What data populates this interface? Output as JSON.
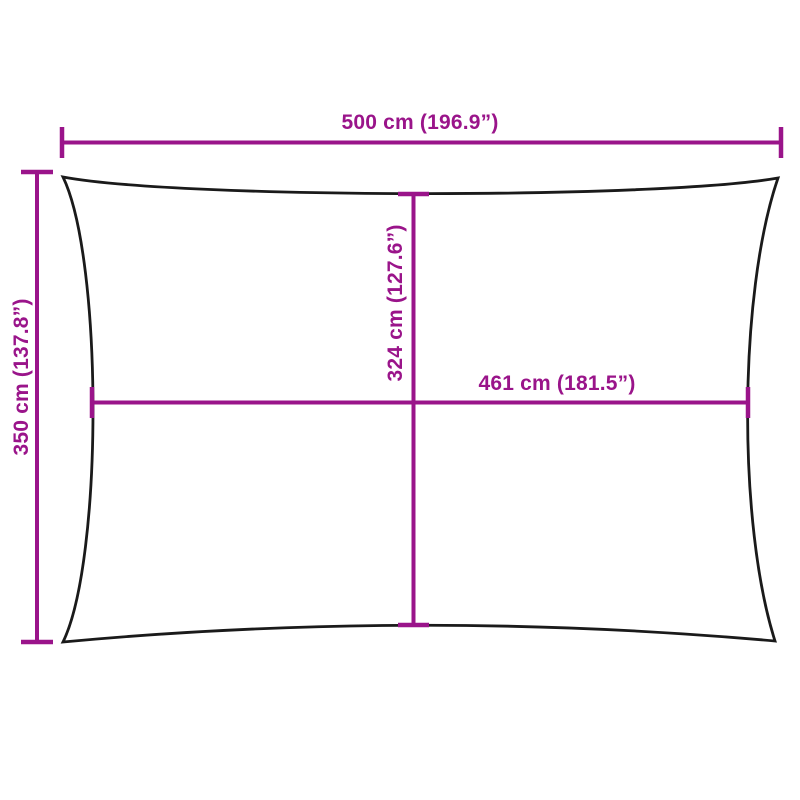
{
  "diagram": {
    "description": "shade-sail-dimension-drawing",
    "colors": {
      "dimension": "#9A148A",
      "outline": "#1A1A1A",
      "background": "#FFFFFF"
    },
    "labels": {
      "top_width": "500 cm (196.9”)",
      "left_height": "350 cm (137.8”)",
      "inner_height": "324 cm (127.6”)",
      "inner_width": "461 cm (181.5”)"
    }
  }
}
